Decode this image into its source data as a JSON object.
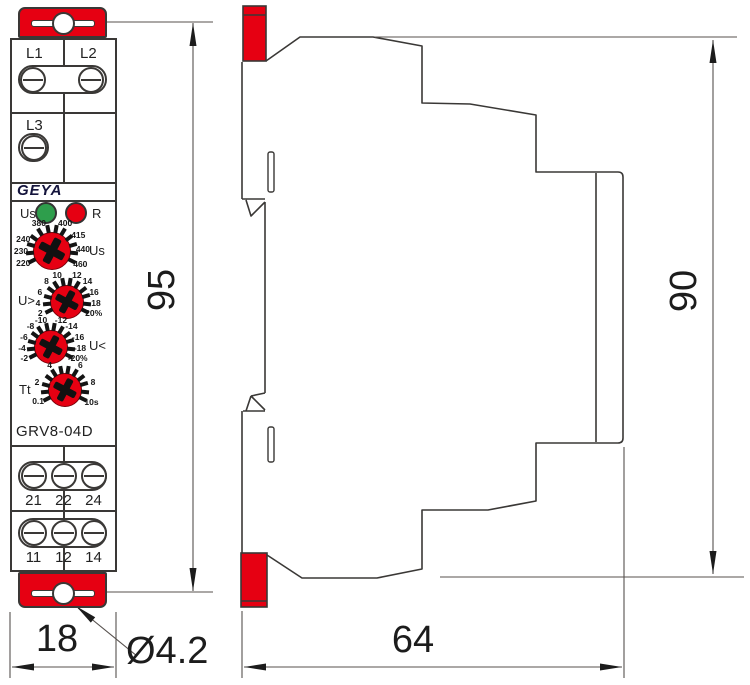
{
  "front": {
    "brand": "GEYA",
    "model": "GRV8-04D",
    "terminals_top": [
      "L1",
      "L2"
    ],
    "terminal_mid": "L3",
    "led_us_label": "Us",
    "led_r_label": "R",
    "dials": [
      {
        "name": "Us",
        "labels": [
          "220",
          "230",
          "240",
          "380",
          "400",
          "415",
          "440",
          "460"
        ]
      },
      {
        "name": "U>",
        "labels": [
          "2",
          "4",
          "6",
          "8",
          "10",
          "12",
          "14",
          "16",
          "18",
          "20%"
        ]
      },
      {
        "name": "U<",
        "labels": [
          "-2",
          "-4",
          "-6",
          "-8",
          "-10",
          "-12",
          "-14",
          "-16",
          "-18",
          "-20%"
        ]
      },
      {
        "name": "Tt",
        "labels": [
          "0.1",
          "2",
          "4",
          "6",
          "8",
          "10s"
        ]
      }
    ],
    "terminal_row_upper": [
      "21",
      "22",
      "24"
    ],
    "terminal_row_lower": [
      "11",
      "12",
      "14"
    ]
  },
  "dimensions": {
    "front_height": "95",
    "front_width": "18",
    "hole_diameter": "Ø4.2",
    "side_height": "90",
    "side_width": "64"
  },
  "colors": {
    "brand_red": "#e60012",
    "led_green": "#2e9e4c",
    "led_red": "#e60012",
    "outline": "#3a3836"
  }
}
